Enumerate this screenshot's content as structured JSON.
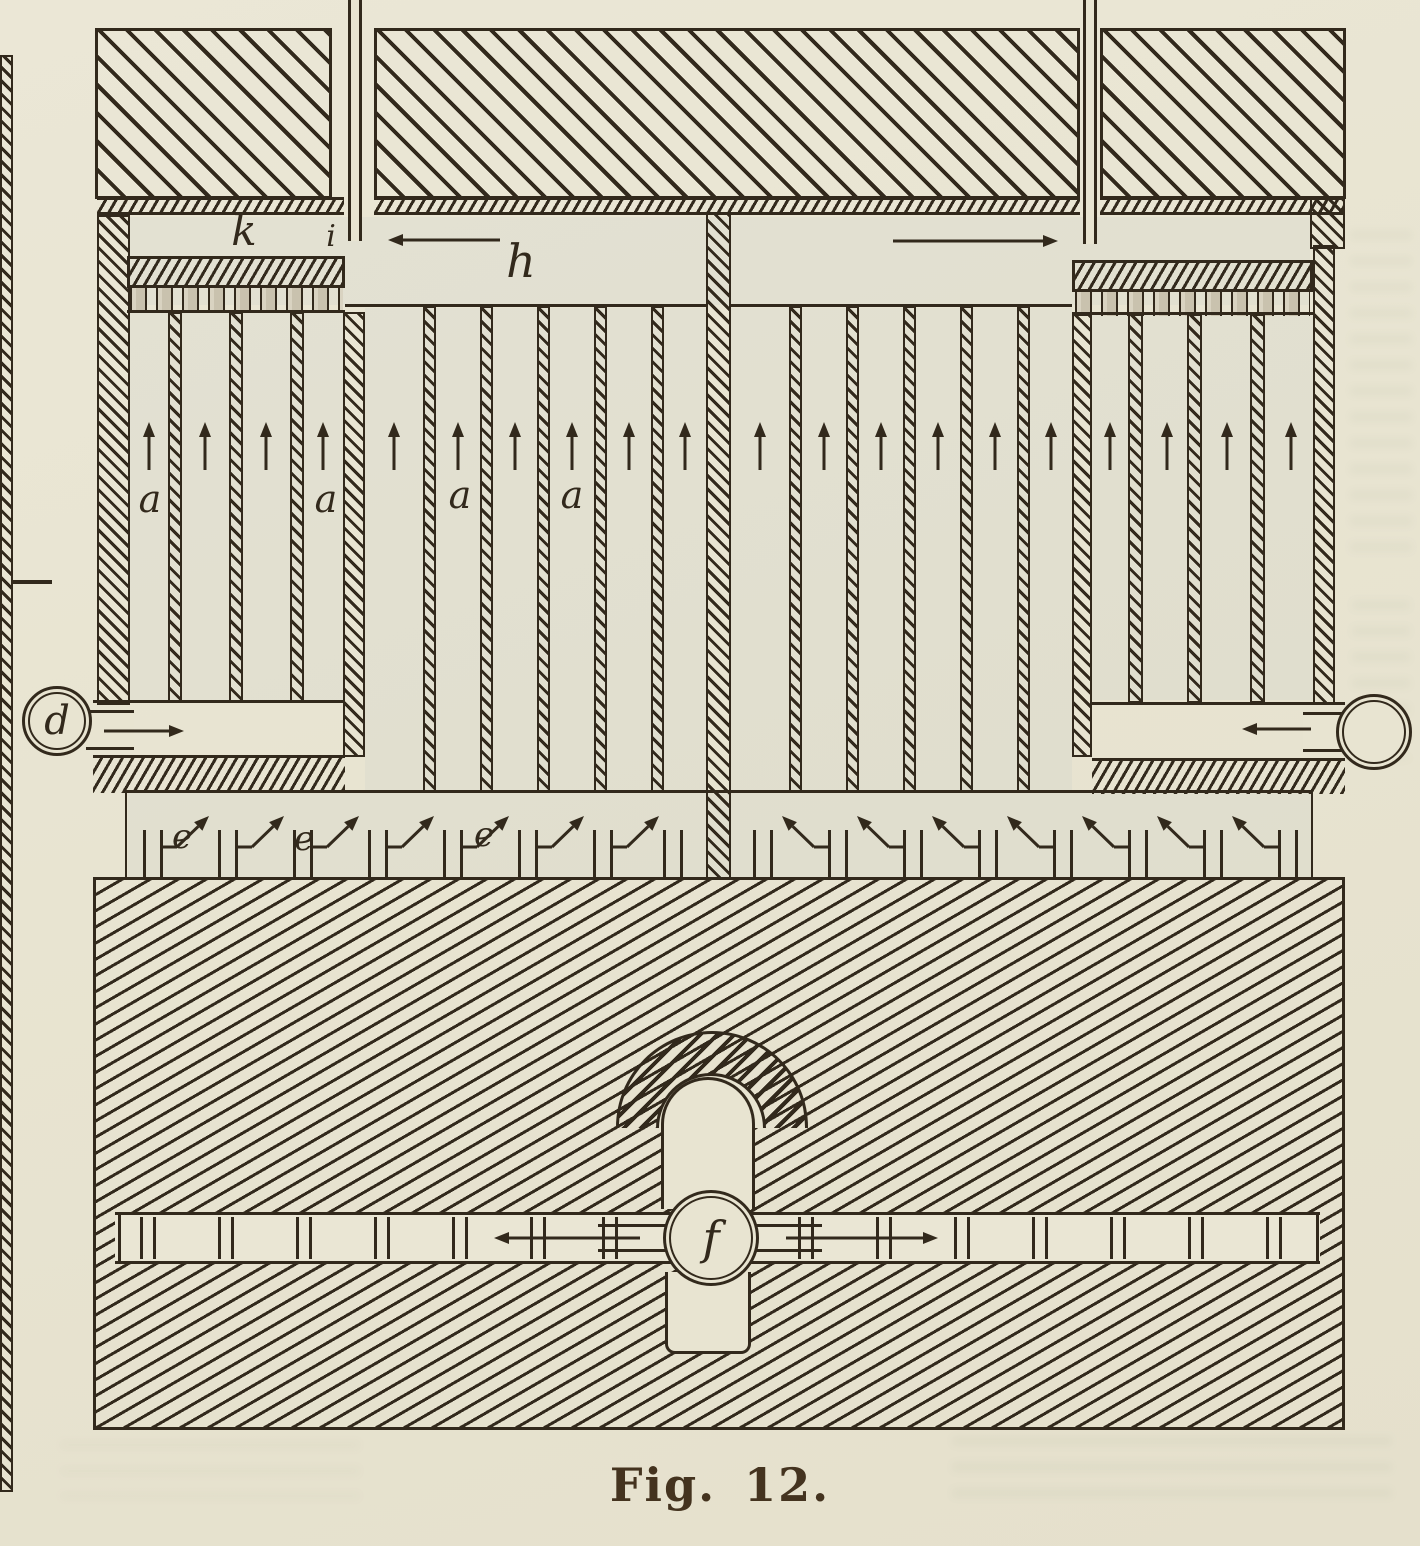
{
  "figure": {
    "caption": "Fig. 12.",
    "labels": {
      "k": "k",
      "i": "i",
      "h": "h",
      "a1": "a",
      "a2": "a",
      "a3": "a",
      "a4": "a",
      "d": "d",
      "e1": "e",
      "e2": "e",
      "e3": "e",
      "f": "f"
    },
    "colors": {
      "paper": "#e8e4d1",
      "ink": "#32291c"
    }
  }
}
